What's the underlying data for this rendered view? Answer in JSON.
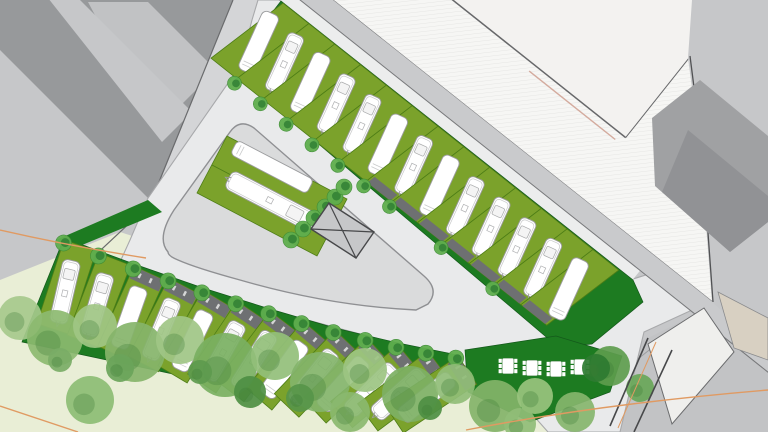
{
  "document": {
    "kind": "Campground / caravan park site plan",
    "view": "top-down architectural drawing",
    "canvas": {
      "width": 768,
      "height": 432
    }
  },
  "palette": {
    "background": "#c6c7c9",
    "building_dark": "#97999b",
    "building_mid": "#a0a1a3",
    "building_inner": "#919295",
    "roof_light": "#c1c2c4",
    "street_west": "#d4d5d7",
    "street_band": "#c9cacc",
    "pavement": "#e9eaeb",
    "curb": "#a8a9ab",
    "edge_dark": "#6a6b6d",
    "outline_dark": "#515254",
    "plaza_white": "#f6f6f4",
    "hatch_line": "#e3e3e1",
    "building_white": "#f3f2f0",
    "pink_edge": "#d4ab9e",
    "site_green": "#1d7b21",
    "pitch_green": "#7ba22b",
    "pitch_edge": "#4d7d16",
    "green_rim": "#14591b",
    "parking_gray": "#6e7072",
    "caravan_white": "#ffffff",
    "caravan_outline": "#9b9c9e",
    "caravan_detail": "#c8c9ca",
    "tree_fill": "#5fae4e",
    "tree_core": "#2e7d32",
    "tree_rim": "#3e8c35",
    "meadow": "#e9eed6",
    "island_gray": "#dadbdc",
    "island_edge": "#8f9093",
    "road_external": "#c2c3c5",
    "beige_building": "#d8d0c2",
    "boundary_orange": "#e09a62",
    "gate_line": "#47484a",
    "hatch_fill_gray": "#c6c7c9"
  },
  "features": {
    "upper_pitch_row": {
      "count": 13,
      "styles": [
        "plain",
        "caravan",
        "plain",
        "caravan",
        "caravan",
        "plain",
        "caravan",
        "plain",
        "caravan",
        "caravan",
        "caravan",
        "caravan",
        "plain"
      ],
      "tree_dividers": [
        1,
        2,
        3,
        4,
        5,
        6,
        7,
        9,
        11
      ],
      "parking_strips": [
        6,
        7,
        8,
        9,
        10,
        11,
        12
      ]
    },
    "lower_pitch_row": {
      "count": 13,
      "styles": [
        "caravan",
        "caravan",
        "plain",
        "caravan",
        "plain",
        "caravan",
        "caravan",
        "plain",
        "caravan",
        "plain",
        "caravan",
        "caravan",
        "plain"
      ],
      "strip_start_index": 2
    },
    "central_island": {
      "pitch_count": 2,
      "styles": [
        "plain",
        "caravan"
      ],
      "tree_count": 6,
      "future_building_symbol": "rectangle with diagonal cross"
    },
    "picnic_tables": {
      "count": 4
    },
    "tree_canopy_belt": {
      "blob_count": 26
    },
    "boundary_lines": {
      "note": "orange parcel boundary lines west and south-east"
    }
  }
}
